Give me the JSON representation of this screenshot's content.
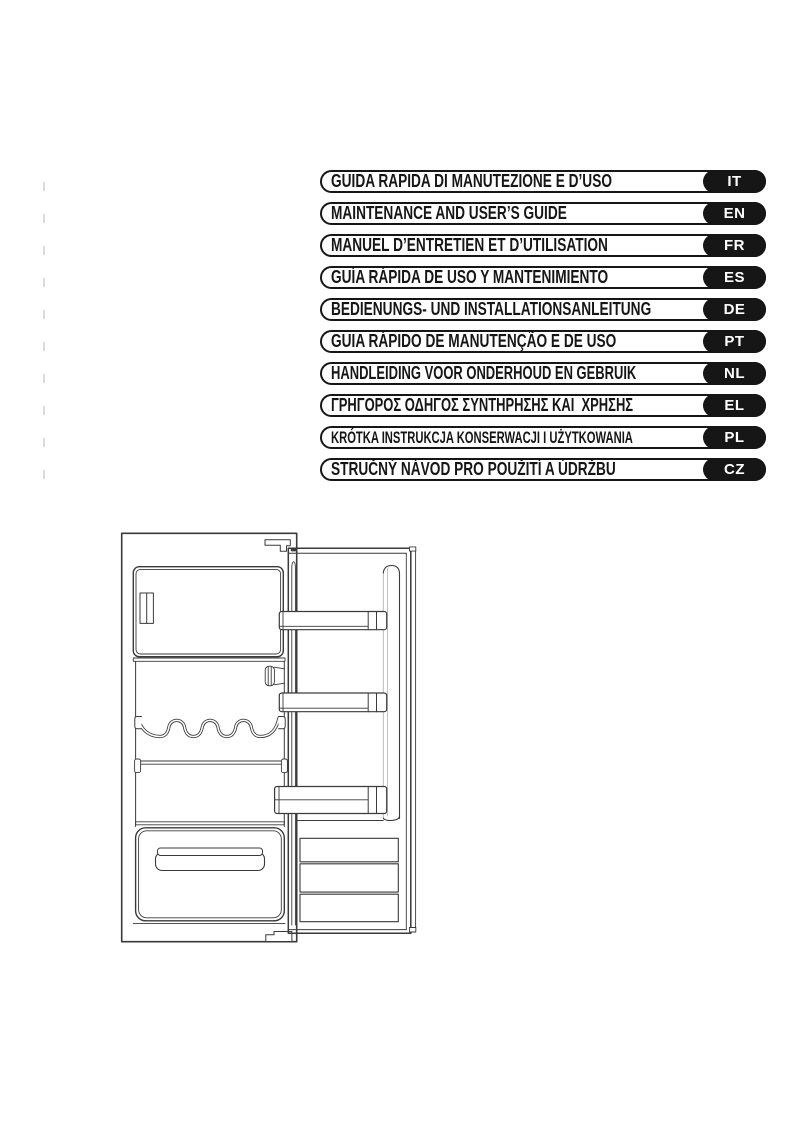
{
  "page": {
    "background": "#ffffff"
  },
  "colors": {
    "banner_border": "#161616",
    "pill_background": "#161616",
    "pill_text": "#ffffff",
    "drawing_stroke": "#3a3a3a",
    "margin_tick": "#dcdce0"
  },
  "banners": [
    {
      "title": "GUIDA RAPIDA DI MANUTEZIONE E D’USO",
      "lang": "IT"
    },
    {
      "title": "MAINTENANCE AND USER’S GUIDE",
      "lang": "EN"
    },
    {
      "title": "MANUEL D’ENTRETIEN ET D’UTILISATION",
      "lang": "FR"
    },
    {
      "title": "GUÍA RÁPIDA DE USO Y MANTENIMIENTO",
      "lang": "ES"
    },
    {
      "title": "BEDIENUNGS- UND INSTALLATIONSANLEITUNG",
      "lang": "DE"
    },
    {
      "title": "GUIA RÁPIDO DE MANUTENÇÃO E DE USO",
      "lang": "PT"
    },
    {
      "title": "HANDLEIDING VOOR ONDERHOUD EN GEBRUIK",
      "lang": "NL"
    },
    {
      "title": "ΓΡΗΓΟΡΟΣ ΟΔΗΓΟΣ ΣΥΝΤΗΡΗΣΗΣ ΚΑΙ  ΧΡΗΣΗΣ",
      "lang": "EL"
    },
    {
      "title": "KRÓTKA INSTRUKCJA KONSERWACJI I UŻYTKOWANIA",
      "lang": "PL"
    },
    {
      "title": "STRUČNÝ NÁVOD PRO POUŽITÍ A ÚDRŽBU",
      "lang": "CZ"
    }
  ],
  "illustration": {
    "alt": "Line drawing of a built-in refrigerator with the door open, showing freezer compartment, thermostat, bottle rack, shelves, crisper drawer and door bins"
  }
}
